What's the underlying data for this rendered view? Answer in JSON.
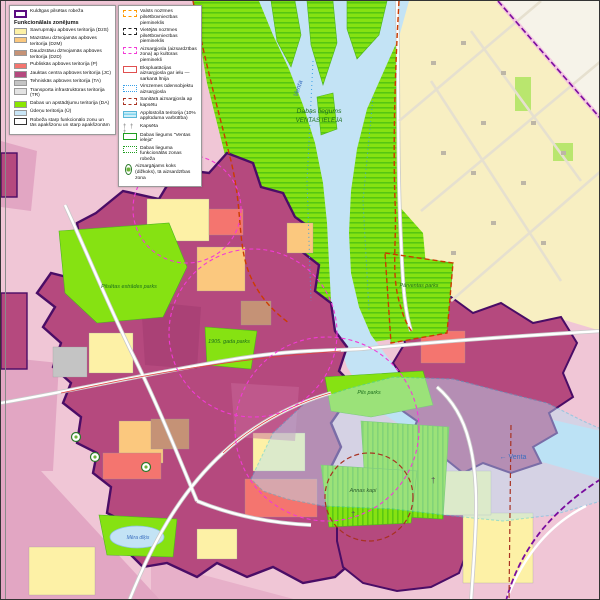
{
  "legend": {
    "panels": {
      "left": {
        "boundary_item": {
          "label": "Kuldīgas pilsētas robeža",
          "color": "#5c0d82"
        },
        "title": "Funkcionālais zonējums",
        "items": [
          {
            "code": "DzS",
            "label": "Savrupmāju apbūves teritorija (DzS)",
            "color": "#fdf1a6"
          },
          {
            "code": "DzM",
            "label": "Mazstāvu dzīvojamās apbūves teritorija (DzM)",
            "color": "#fbc87e"
          },
          {
            "code": "DzD",
            "label": "Daudzstāvu dzīvojamās apbūves teritorija (DzD)",
            "color": "#c59276"
          },
          {
            "code": "P",
            "label": "Publiskās apbūves teritorija (P)",
            "color": "#f4756f"
          },
          {
            "code": "JC",
            "label": "Jauktas centra apbūves teritorija (JC)",
            "color": "#b5497e"
          },
          {
            "code": "TA",
            "label": "Tehniskās apbūves teritorija (TA)",
            "color": "#c4c4c4"
          },
          {
            "code": "TR",
            "label": "Transporta infrastruktūras teritorija (TR)",
            "color": "#e3e3e3"
          },
          {
            "code": "DA",
            "label": "Dabas un apstādījumu teritorija (DA)",
            "color": "#8ae600"
          },
          {
            "code": "Ū",
            "label": "Ūdeņu teritorija (Ū)",
            "color": "#c9e6f7"
          },
          {
            "code": "robeža",
            "label": "Robeža starp funkcionālo zonu un tās apakšzonu un starp apakšzonām",
            "color": "#ffffff"
          }
        ]
      },
      "right": {
        "items": [
          {
            "label": "Valsts nozīmes pilsētbūvniecības piemineklis"
          },
          {
            "label": "Vietējās nozīmes pilsētbūvniecības piemineklis"
          },
          {
            "label": "Aizsargjosla (aizsardzības zona) ap kultūras pieminekli"
          },
          {
            "label": "Ekspluatācijas aizsargjosla gar ielu — sarkanā līnija"
          },
          {
            "label": "Virszemes ūdensobjektu aizsargjosla"
          },
          {
            "label": "Sanitārā aizsargjosla ap kapsētu"
          },
          {
            "label": "Applūstošā teritorija (10% applūduma varbūtība)"
          },
          {
            "label": "Kapsēta",
            "glyph": "† † †"
          },
          {
            "label": "Dabas liegums \"Ventas ieleja\""
          },
          {
            "label": "Dabas lieguma funkcionālās zonas robeža"
          },
          {
            "label": "Aizsargājams koks (dižkoks), tā aizsardzības zona"
          }
        ]
      }
    }
  },
  "map": {
    "labels": {
      "reserve_line1": "Dabas liegums",
      "reserve_line2": "VENTAS IELEJA",
      "venta_top": "Venta",
      "venta_right": "← Venta",
      "estrades_parks": "Pilsētas estrādes parks",
      "gada_parks": "1905. gada parks",
      "parventas_parks": "Pārventas parks",
      "pils_parks": "Pils parks",
      "annas_kapi": "Annas kapi",
      "mera_dikis": "Mēra dīķis"
    },
    "symbols": {
      "cross": "†"
    },
    "colors": {
      "outside_pink": "#f0c6d6",
      "outside_pink_dark": "#e2a6c3",
      "beyond_boundary": "#f6f3e9",
      "dzs_parcels": "#f8efc2",
      "jc_core": "#b5497e",
      "da_green": "#86e212",
      "water": "#c3e3f5",
      "city_boundary": "#4a0d66",
      "reserve_border": "#cc3b00",
      "flood_line": "#35c8ea",
      "monument_zone": "#f23ad6",
      "sanitary_zone": "#a83222",
      "red_line": "#e04040"
    }
  }
}
